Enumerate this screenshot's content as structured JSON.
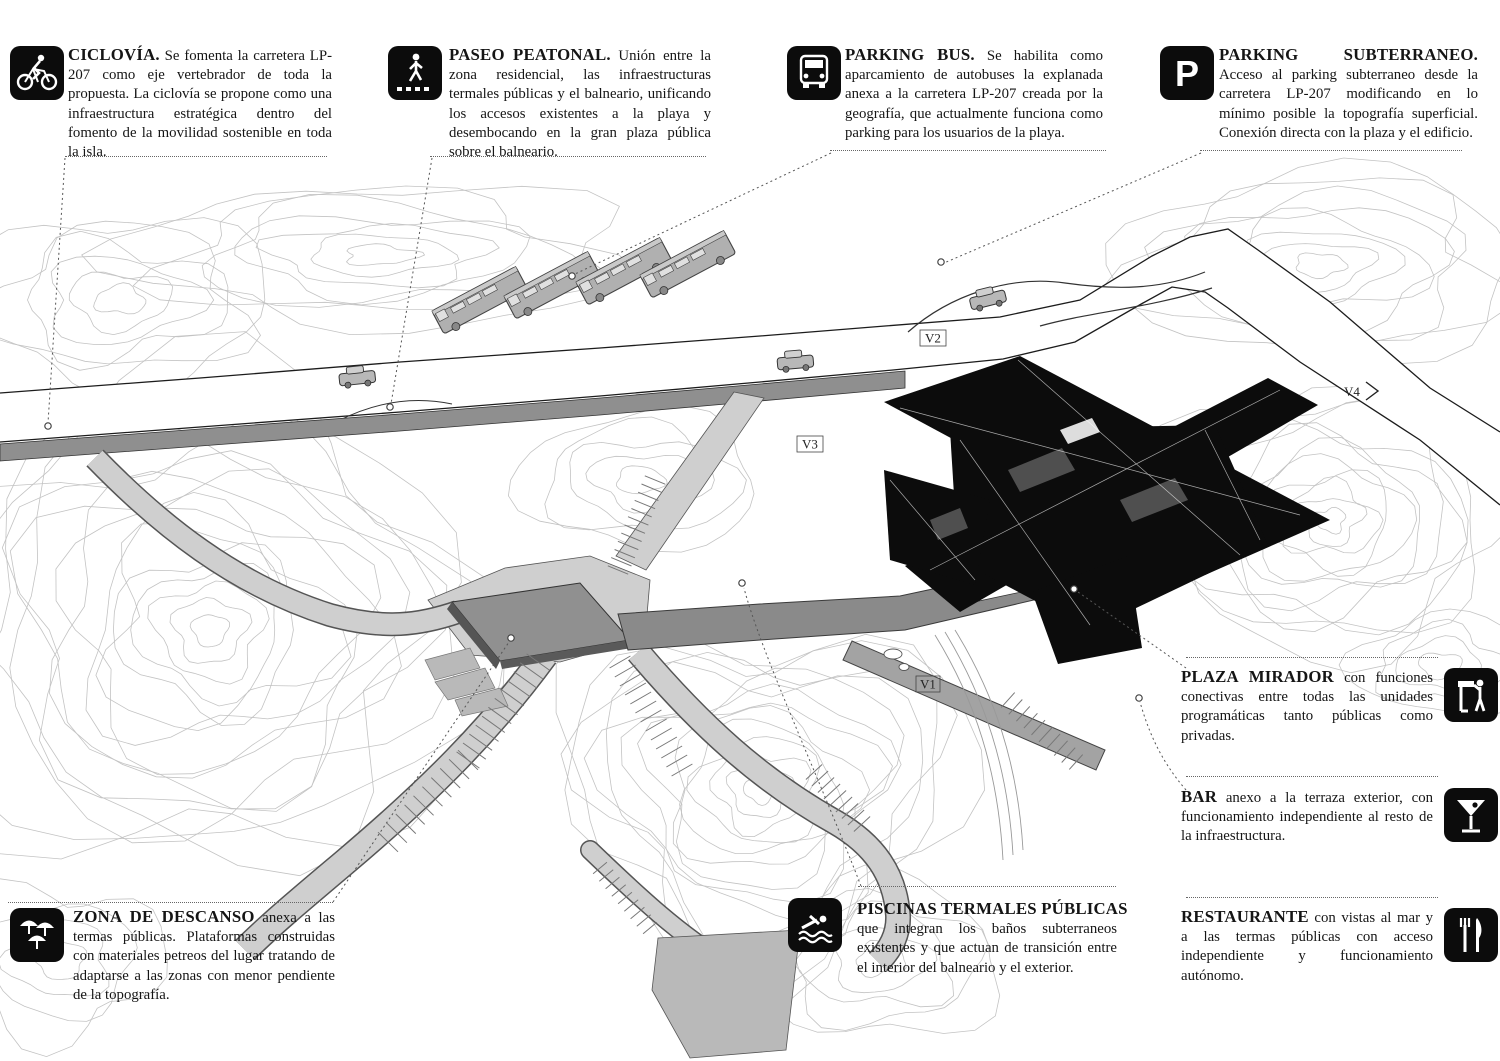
{
  "annotations": [
    {
      "id": "ciclovia",
      "icon": "bicycle-icon",
      "title": "CICLOVÍA.",
      "body": "Se fomenta la carretera LP-207 como eje vertebrador de toda la propuesta. La ciclovía se propone como una infraestructura estratégica dentro del fomento de la movilidad sostenible en toda la isla."
    },
    {
      "id": "paseo-peatonal",
      "icon": "pedestrian-icon",
      "title": "PASEO PEATONAL.",
      "body": "Unión entre la zona residencial, las infraestructuras termales públicas y el balneario, unificando los accesos existentes a la playa y  desembocando en la gran plaza pública sobre el balneario."
    },
    {
      "id": "parking-bus",
      "icon": "bus-icon",
      "title": "PARKING BUS.",
      "body": "Se habilita como aparcamiento de autobuses la explanada anexa a la carretera LP-207 creada por la geografía, que actualmente funciona como parking para los usuarios de la playa."
    },
    {
      "id": "parking-subterraneo",
      "icon": "parking-icon",
      "title": "PARKING SUBTERRANEO.",
      "body": "Acceso al parking subterraneo desde la carretera LP-207 modificando en lo mínimo posible la topografía superficial. Conexión directa con la plaza y el edificio."
    },
    {
      "id": "plaza-mirador",
      "icon": "viewpoint-icon",
      "title": "PLAZA MIRADOR",
      "body": "con funciones conectivas entre todas las unidades programáticas tanto públicas como privadas."
    },
    {
      "id": "bar",
      "icon": "cocktail-icon",
      "title": "BAR",
      "body": "anexo a la terraza exterior, con funcionamiento independiente al resto de la infraestructura."
    },
    {
      "id": "restaurante",
      "icon": "restaurant-icon",
      "title": "RESTAURANTE",
      "body": "con vistas al mar y a las termas públicas con acceso independiente y funcionamiento autónomo."
    },
    {
      "id": "piscinas-termales",
      "icon": "swimmer-icon",
      "title": "PISCINAS TERMALES PÚBLICAS",
      "body": "que integran los baños subterraneos existentes y que actuan de transición entre el interior del balneario y el exterior."
    },
    {
      "id": "zona-descanso",
      "icon": "umbrellas-icon",
      "title": "ZONA DE DESCANSO",
      "body": "anexa a las termas públicas. Plataformas construidas con materiales petreos del lugar tratando de adaptarse a las zonas con menor pendiente de la topografía."
    }
  ],
  "map_labels": {
    "v1": "V1",
    "v2": "V2",
    "v3": "V3",
    "v4": "V4"
  },
  "colors": {
    "ink": "#111111",
    "building": "#0c0c0c",
    "contour": "#c3c3c3",
    "path_light": "#cfcfcf",
    "path_dark": "#8a8a8a",
    "leader": "#555555"
  }
}
